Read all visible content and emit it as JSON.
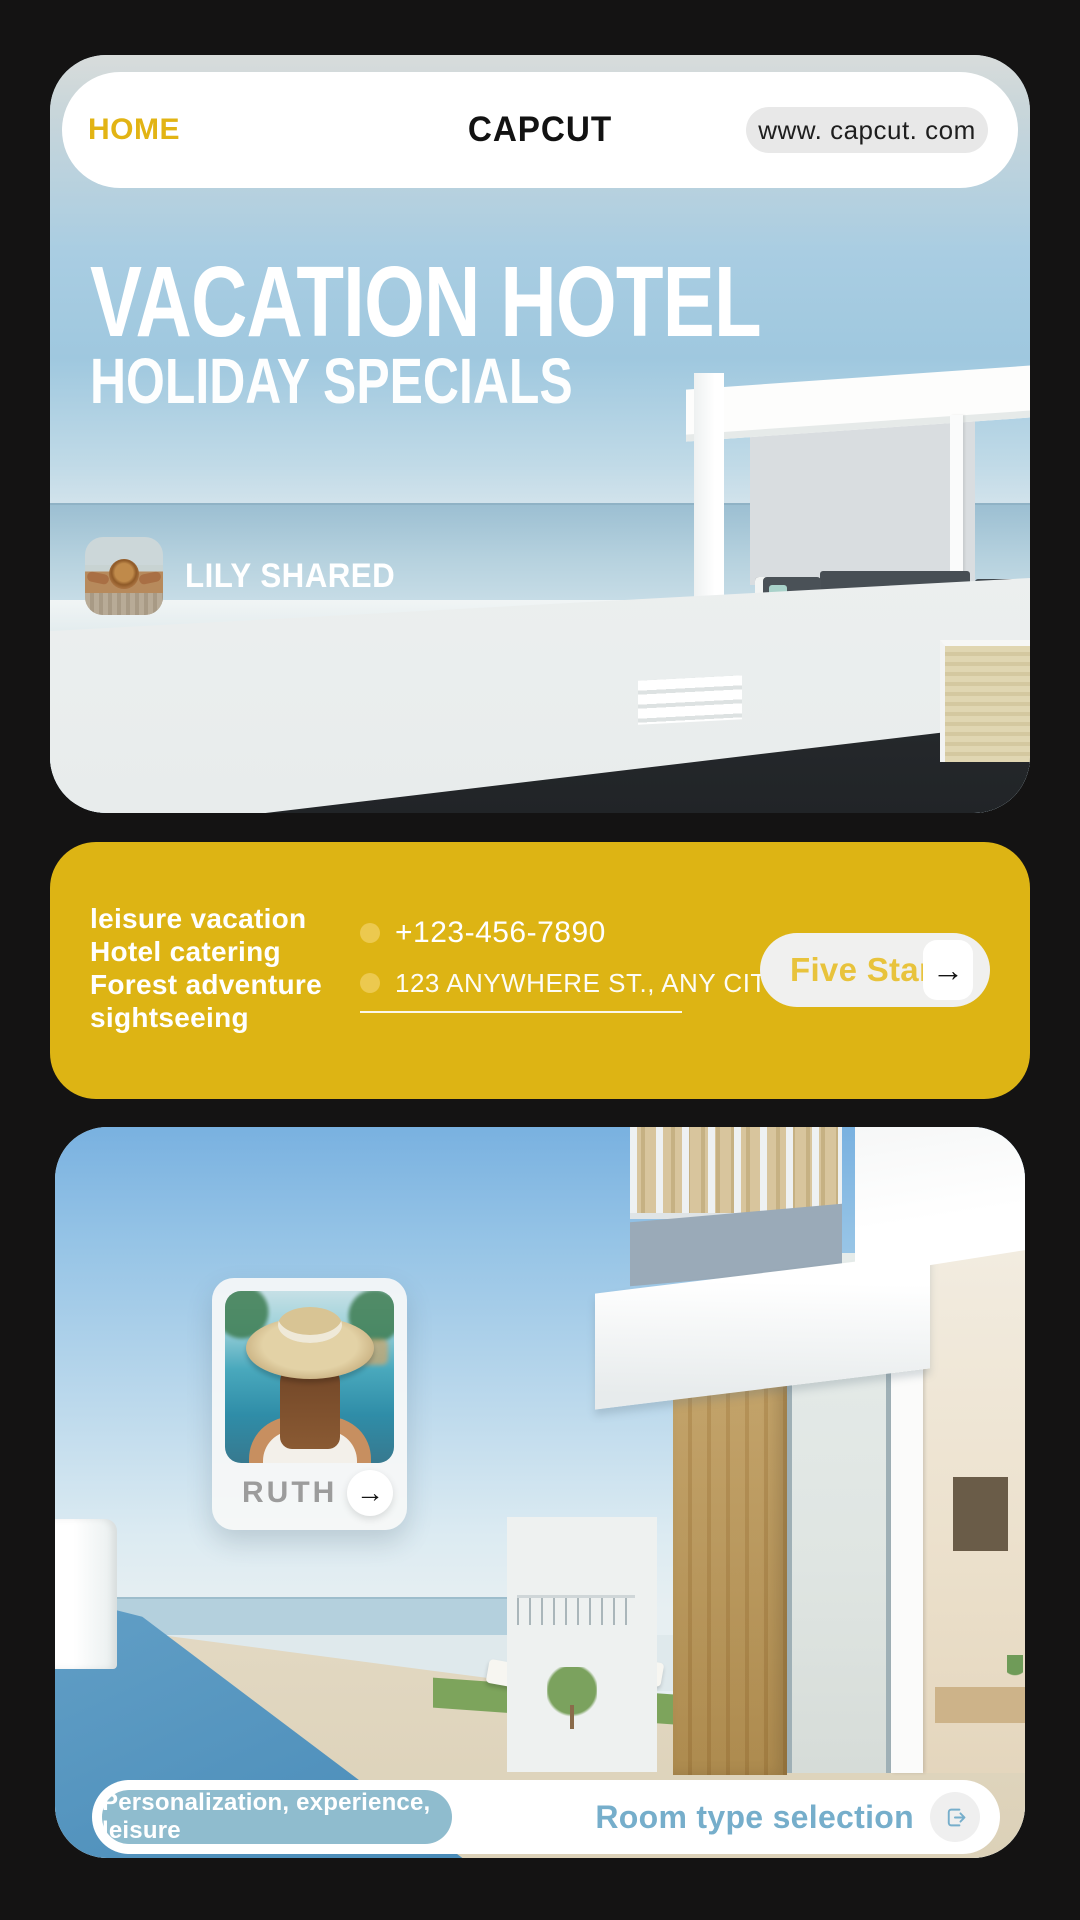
{
  "theme": {
    "accent_yellow": "#DDB414",
    "pill_blue": "#8FBCCE",
    "link_blue": "#76AECB",
    "background": "#141313"
  },
  "header": {
    "home": "HOME",
    "brand": "CAPCUT",
    "url": "www. capcut. com"
  },
  "hero": {
    "title": "VACATION HOTEL",
    "subtitle": "HOLIDAY SPECIALS",
    "shared": "LILY SHARED"
  },
  "info": {
    "services": [
      "leisure vacation",
      "Hotel catering",
      "Forest adventure",
      "sightseeing"
    ],
    "phone": "+123-456-7890",
    "address": "123 ANYWHERE ST., ANY CITY",
    "cta": "Five Stars",
    "arrow": "→"
  },
  "room": {
    "guest": "RUTH",
    "arrow": "→",
    "tag": "Personalization, experience, leisure",
    "cta": "Room type selection"
  }
}
